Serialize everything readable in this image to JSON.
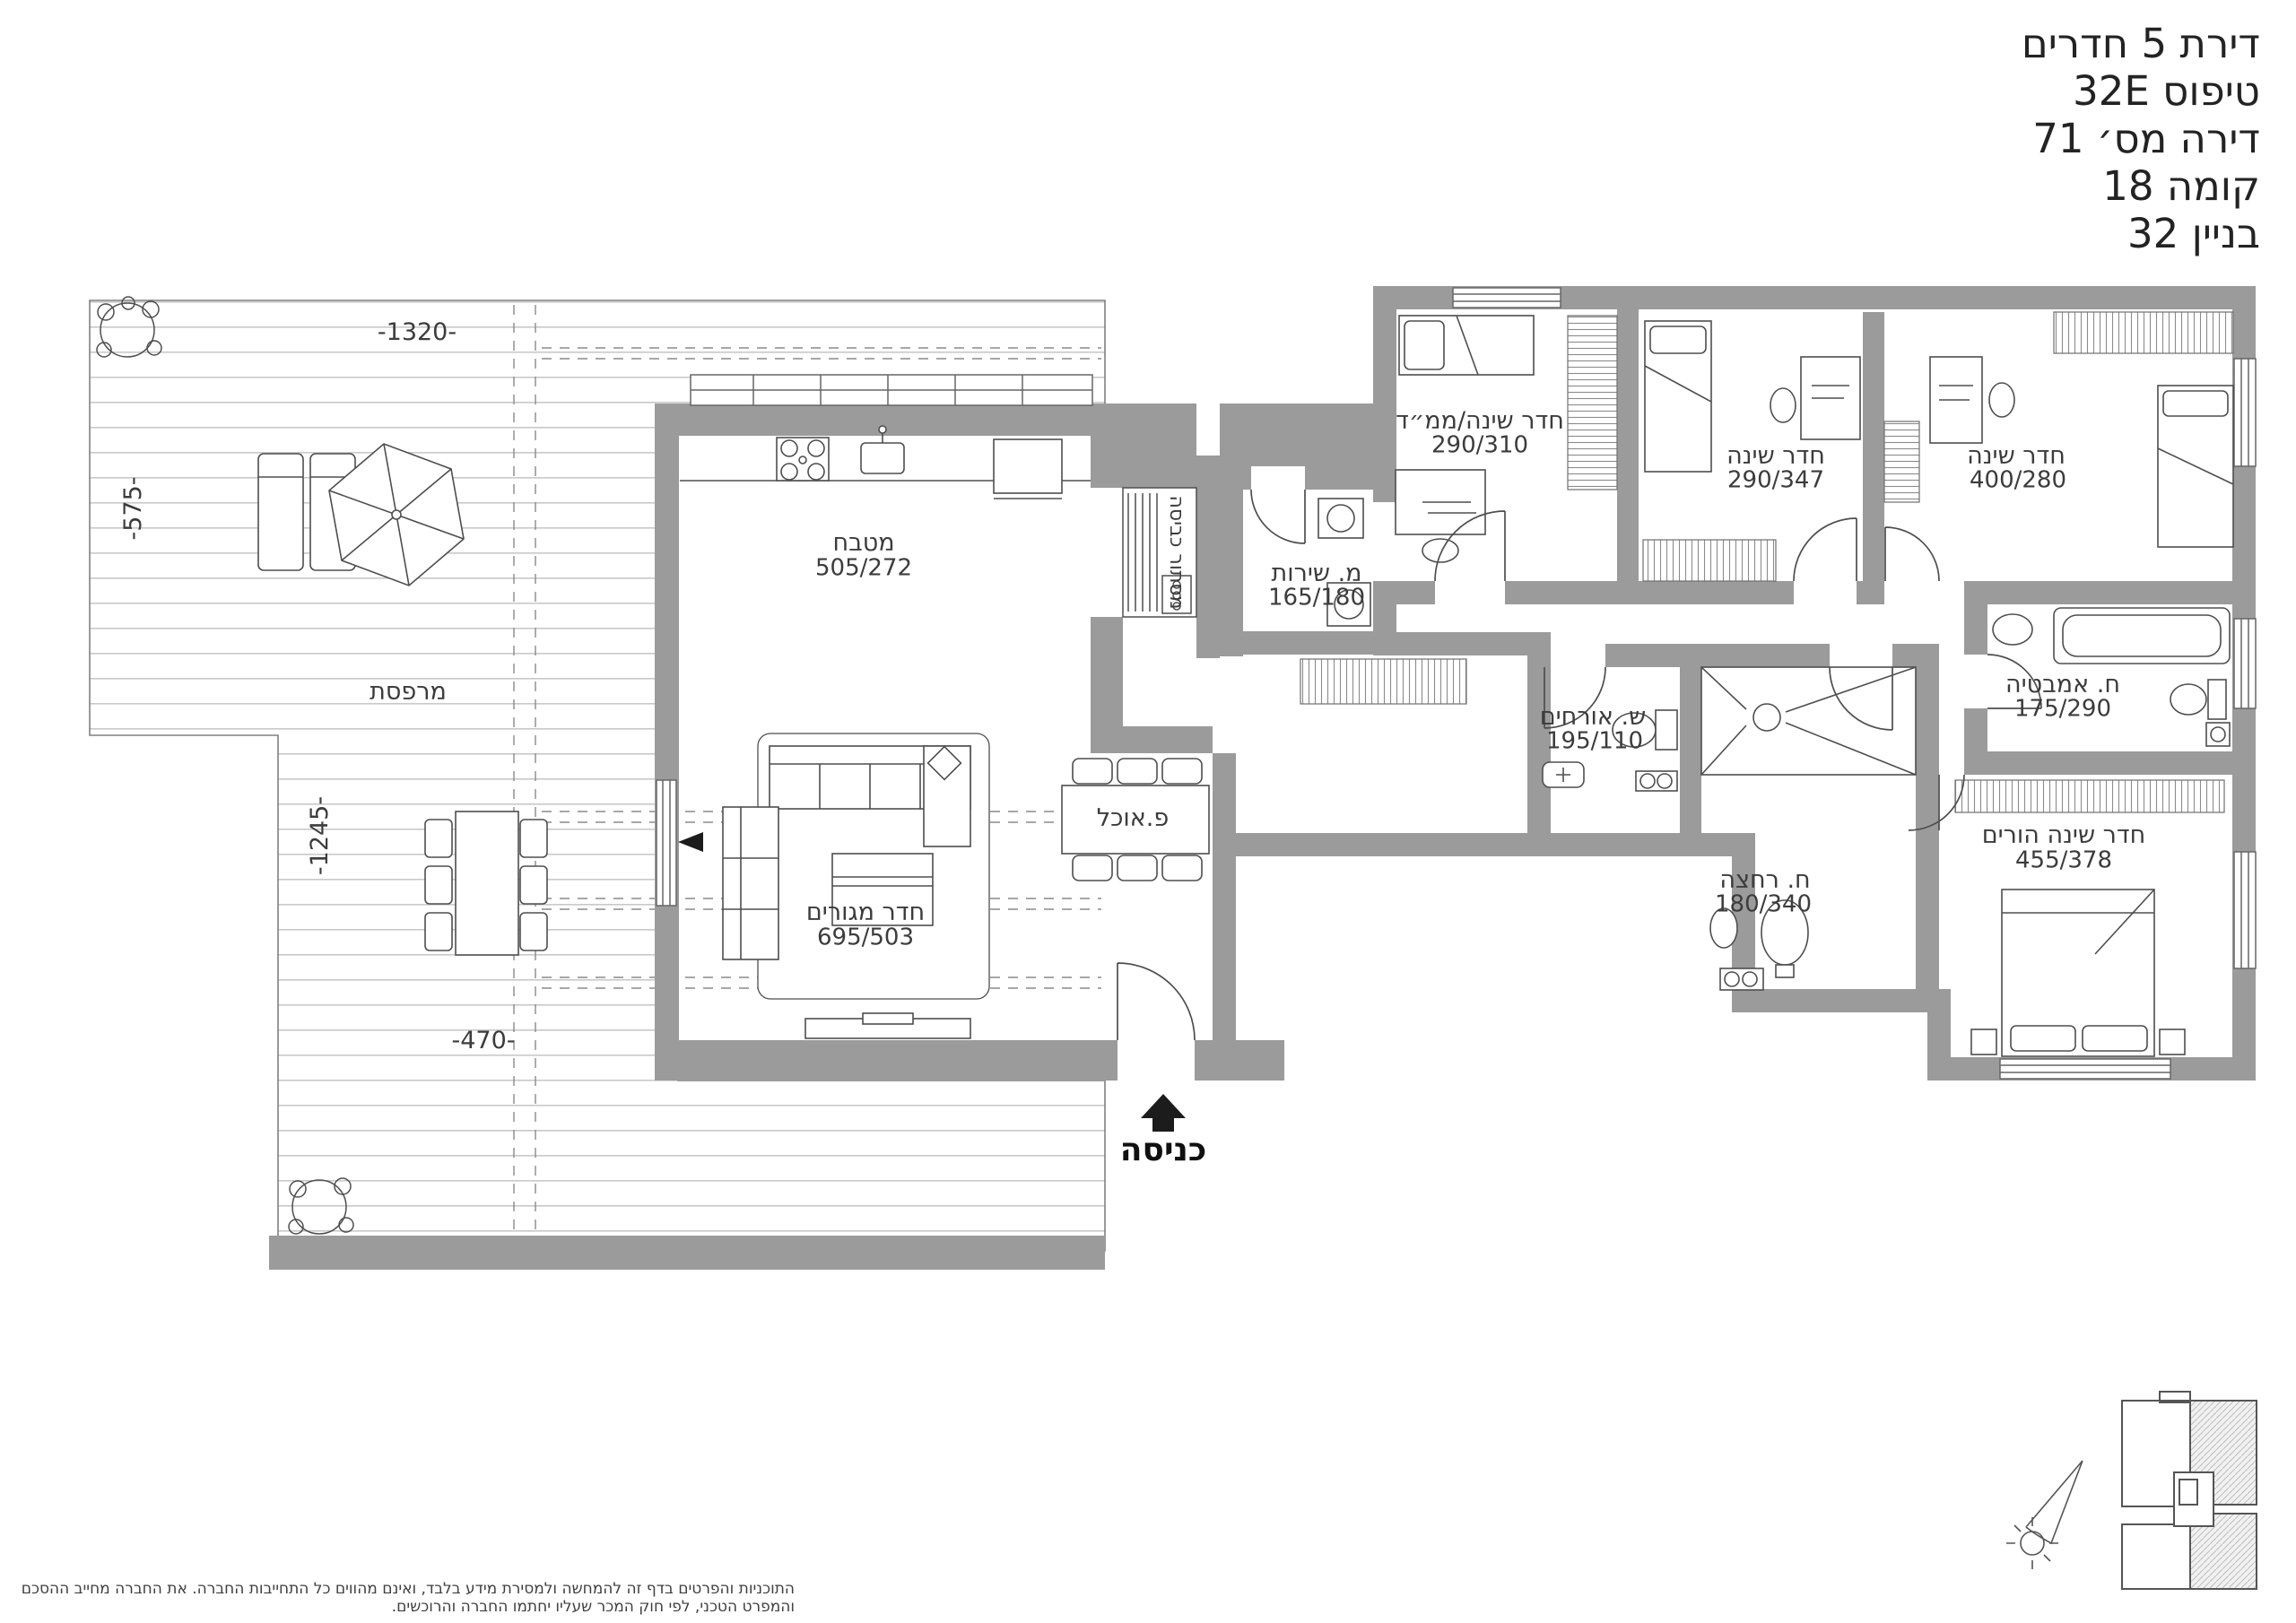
{
  "title_block": {
    "lines": [
      "דירת 5 חדרים",
      "טיפוס 32E",
      "דירה מס׳ 71",
      "קומה 18",
      "בניין 32"
    ]
  },
  "rooms": {
    "kitchen": {
      "name": "מטבח",
      "dims": "505/272"
    },
    "living": {
      "name": "חדר מגורים",
      "dims": "695/503"
    },
    "dining": {
      "name": "פ.אוכל"
    },
    "service_wc": {
      "name": "מ. שירות",
      "dims": "165/180"
    },
    "mamad": {
      "name": "חדר שינה/ממ״ד",
      "dims": "290/310"
    },
    "bedroom2": {
      "name": "חדר שינה",
      "dims": "290/347"
    },
    "bedroom3": {
      "name": "חדר שינה",
      "dims": "400/280"
    },
    "bathroom": {
      "name": "ח. אמבטיה",
      "dims": "175/290"
    },
    "guest_wc": {
      "name": "ש. אורחים",
      "dims": "195/110"
    },
    "shower": {
      "name": "ח. רחצה",
      "dims": "180/340"
    },
    "master": {
      "name": "חדר שינה הורים",
      "dims": "455/378"
    }
  },
  "terrace": {
    "name": "מרפסת",
    "dimensions": {
      "top": "-1320-",
      "left_upper": "-575-",
      "left_lower": "-1245-",
      "bottom": "-470-"
    }
  },
  "laundry": {
    "name": "מסתור כביסה"
  },
  "entrance": {
    "label": "כניסה",
    "arrow_icon": "filled-up-arrow"
  },
  "legend": {
    "north_arrow": "compass-needle",
    "key_plan": "building-outline-unit-highlighted"
  },
  "disclaimer": "התוכניות והפרטים בדף זה להמחשה ולמסירת מידע בלבד, ואינם מהווים כל התחייבות החברה. את החברה מחייב ההסכם והמפרט הטכני, לפי חוק המכר שעליו יחתמו החברה והרוכשים.",
  "colors": {
    "wall": "#9b9b9b",
    "line": "#4e4e4e",
    "text": "#3c3c3c",
    "deck_line": "#c9c9c9",
    "hatch": "#bdbdbd"
  }
}
